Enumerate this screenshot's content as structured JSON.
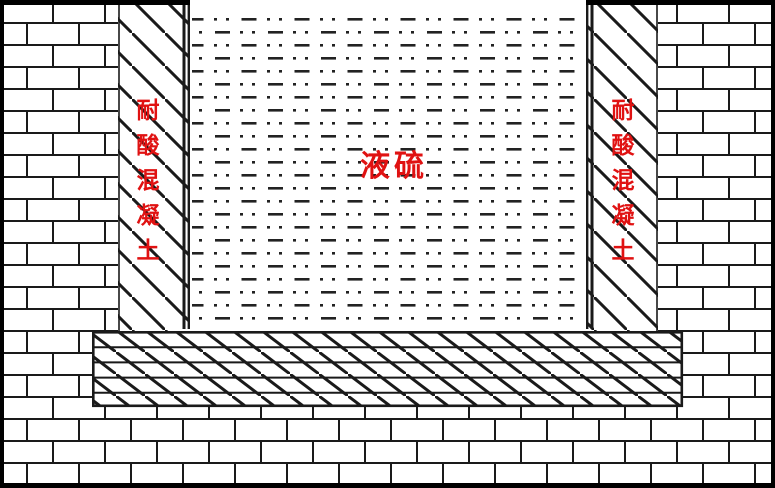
{
  "diagram": {
    "labels": {
      "liquid": "液硫",
      "left_column_material": "耐酸混凝土",
      "right_column_material": "耐酸混凝土"
    },
    "colors": {
      "label_red": "#e01212",
      "line": "#1a1a1a",
      "background": "#ffffff"
    }
  }
}
